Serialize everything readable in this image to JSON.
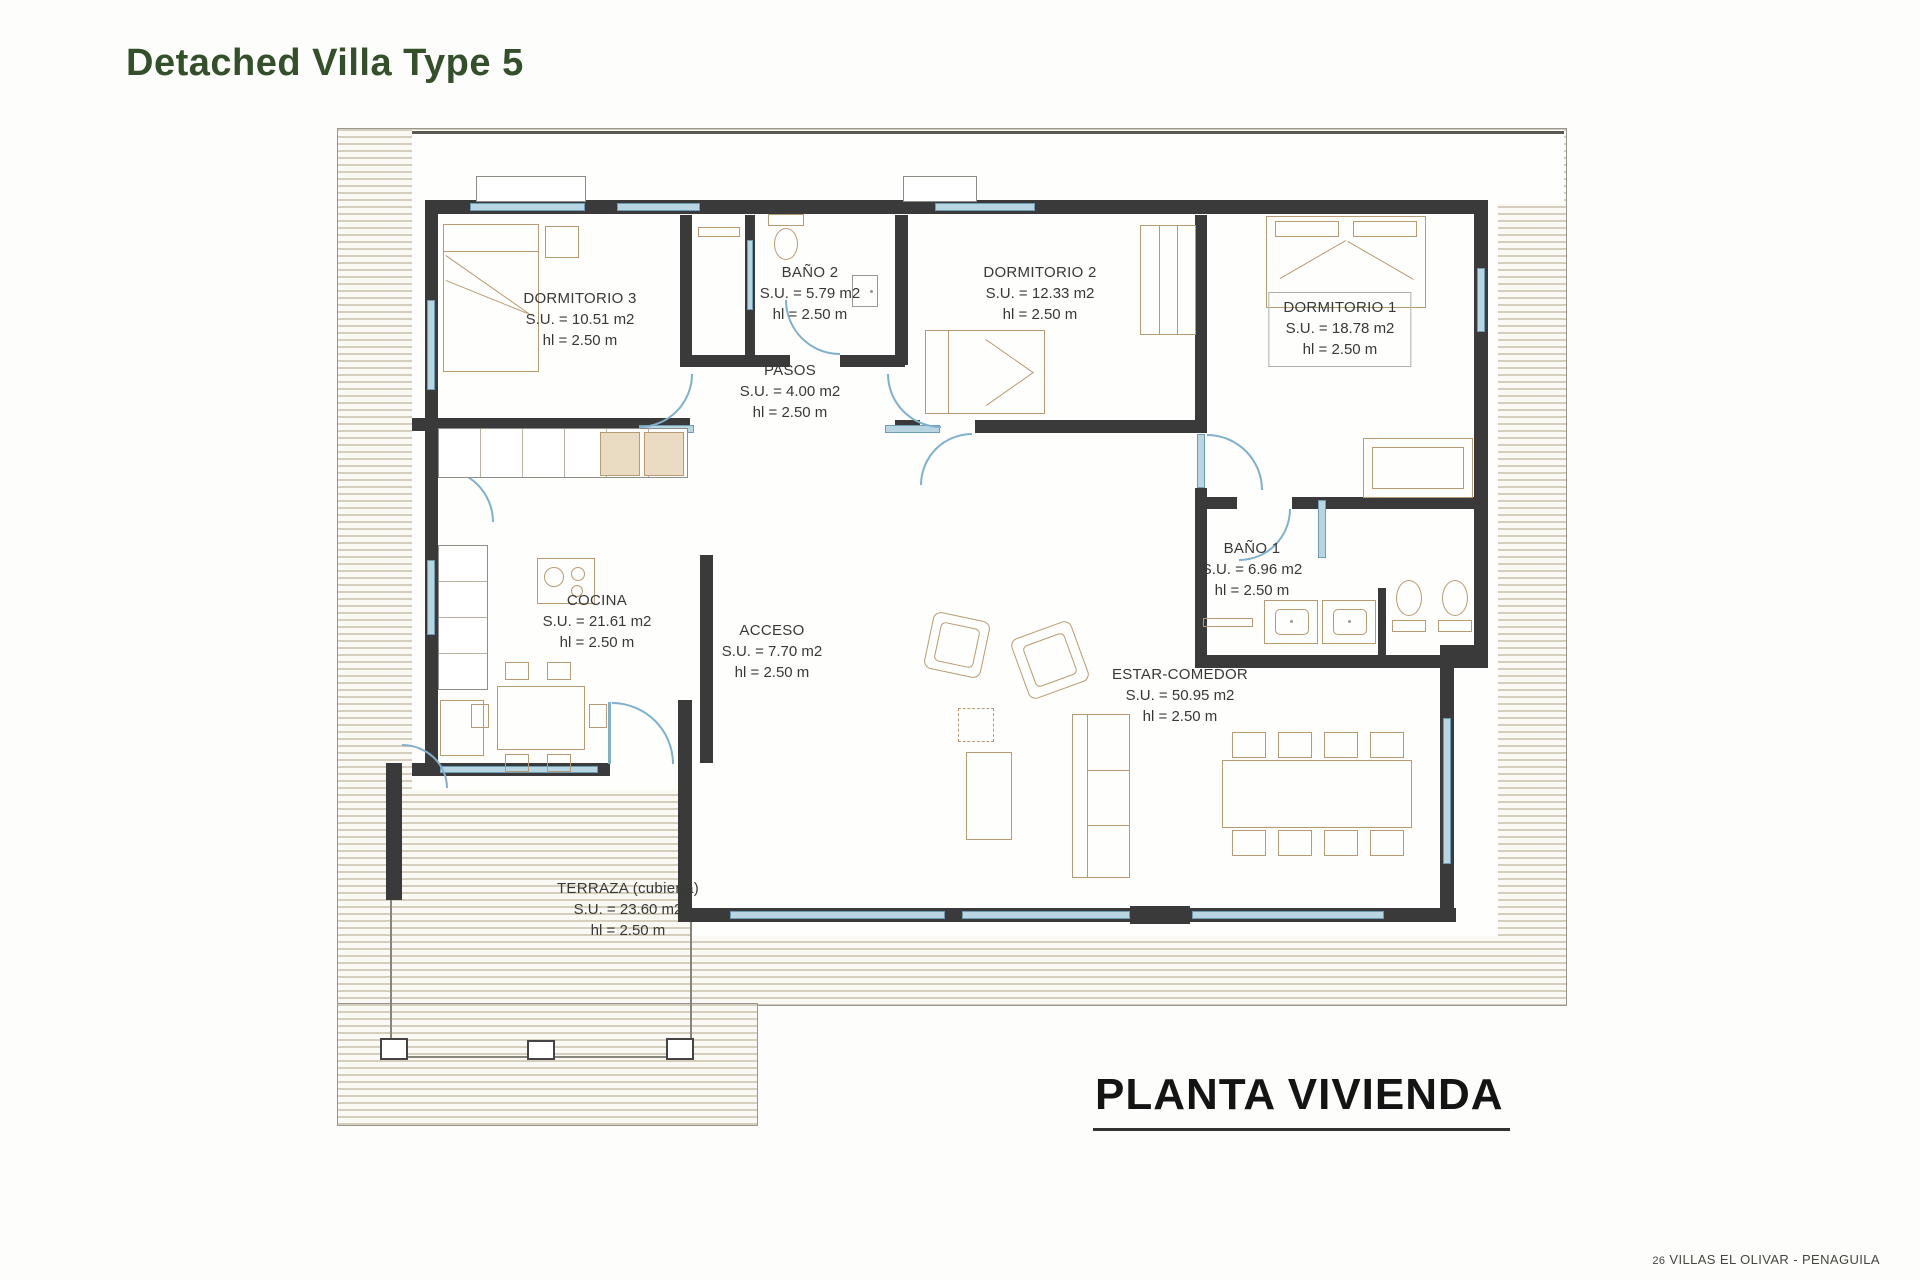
{
  "header": {
    "title": "Detached Villa Type 5"
  },
  "caption": {
    "text": "PLANTA VIVIENDA"
  },
  "footer": {
    "page": "26",
    "project": "VILLAS EL OLIVAR - PENAGUILA"
  },
  "rooms": [
    {
      "key": "dormitorio3",
      "name": "DORMITORIO 3",
      "su": "S.U. = 10.51 m2",
      "hl": "hl = 2.50 m"
    },
    {
      "key": "bano2",
      "name": "BAÑO 2",
      "su": "S.U. = 5.79 m2",
      "hl": "hl = 2.50 m"
    },
    {
      "key": "dormitorio2",
      "name": "DORMITORIO 2",
      "su": "S.U. = 12.33 m2",
      "hl": "hl = 2.50 m"
    },
    {
      "key": "dormitorio1",
      "name": "DORMITORIO 1",
      "su": "S.U. = 18.78 m2",
      "hl": "hl = 2.50 m"
    },
    {
      "key": "pasos",
      "name": "PASOS",
      "su": "S.U. = 4.00 m2",
      "hl": "hl = 2.50 m"
    },
    {
      "key": "cocina",
      "name": "COCINA",
      "su": "S.U. = 21.61 m2",
      "hl": "hl = 2.50 m"
    },
    {
      "key": "acceso",
      "name": "ACCESO",
      "su": "S.U. = 7.70 m2",
      "hl": "hl = 2.50 m"
    },
    {
      "key": "bano1",
      "name": "BAÑO 1",
      "su": "S.U. = 6.96 m2",
      "hl": "hl = 2.50 m"
    },
    {
      "key": "estar",
      "name": "ESTAR-COMEDOR",
      "su": "S.U. = 50.95 m2",
      "hl": "hl = 2.50 m"
    },
    {
      "key": "terraza",
      "name": "TERRAZA (cubierta)",
      "su": "S.U. = 23.60 m2",
      "hl": "hl = 2.50 m"
    }
  ],
  "colors": {
    "title_green": "#33502a",
    "wall": "#3a3a3a",
    "window_blue": "#b8d6e2",
    "hatch_line": "#d5cebd",
    "furniture_tan": "#b89b72"
  }
}
